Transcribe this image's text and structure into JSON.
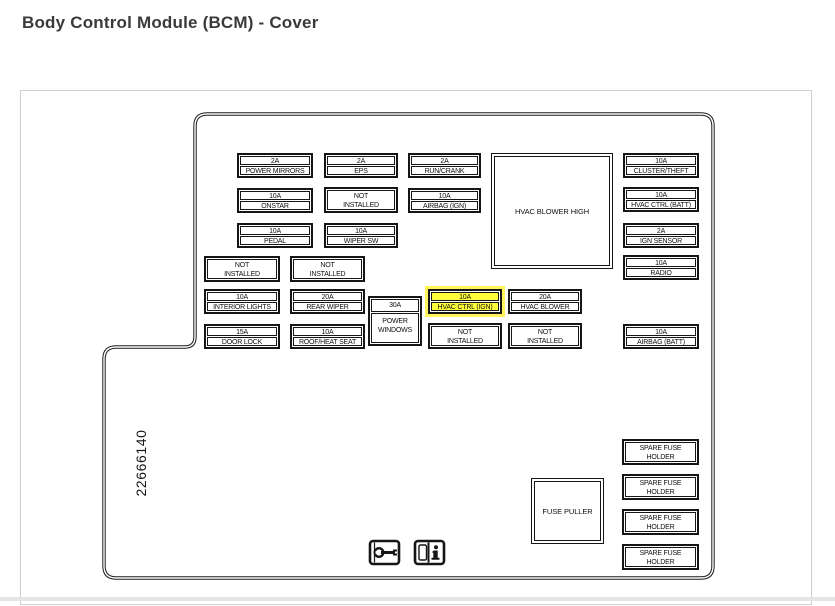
{
  "page": {
    "title": "Body Control Module (BCM) - Cover"
  },
  "diagram": {
    "part_number": "22666140",
    "highlight_color": "#ffff3c",
    "blocks": {
      "hvac_blower_high": "HVAC BLOWER HIGH",
      "fuse_puller": "FUSE PULLER"
    },
    "fuses": [
      {
        "amp": "2A",
        "name": "POWER MIRRORS"
      },
      {
        "amp": "2A",
        "name": "EPS"
      },
      {
        "amp": "2A",
        "name": "RUN/CRANK"
      },
      {
        "amp": "10A",
        "name": "CLUSTER/THEFT"
      },
      {
        "amp": "10A",
        "name": "ONSTAR"
      },
      {
        "label": "NOT\nINSTALLED"
      },
      {
        "amp": "10A",
        "name": "AIRBAG (IGN)"
      },
      {
        "amp": "10A",
        "name": "HVAC CTRL (BATT)"
      },
      {
        "amp": "10A",
        "name": "PEDAL"
      },
      {
        "amp": "10A",
        "name": "WIPER SW"
      },
      {
        "amp": "2A",
        "name": "IGN SENSOR"
      },
      {
        "label": "NOT\nINSTALLED"
      },
      {
        "label": "NOT\nINSTALLED"
      },
      {
        "amp": "10A",
        "name": "RADIO"
      },
      {
        "amp": "10A",
        "name": "INTERIOR LIGHTS"
      },
      {
        "amp": "20A",
        "name": "REAR WIPER"
      },
      {
        "amp": "30A",
        "name": "POWER\nWINDOWS"
      },
      {
        "amp": "10A",
        "name": "HVAC CTRL (IGN)",
        "highlighted": true
      },
      {
        "amp": "20A",
        "name": "HVAC BLOWER"
      },
      {
        "amp": "15A",
        "name": "DOOR LOCK"
      },
      {
        "amp": "10A",
        "name": "ROOF/HEAT SEAT"
      },
      {
        "label": "NOT\nINSTALLED"
      },
      {
        "label": "NOT\nINSTALLED"
      },
      {
        "amp": "10A",
        "name": "AIRBAG (BATT)"
      }
    ],
    "spares": [
      {
        "label": "SPARE FUSE\nHOLDER"
      },
      {
        "label": "SPARE FUSE\nHOLDER"
      },
      {
        "label": "SPARE FUSE\nHOLDER"
      },
      {
        "label": "SPARE FUSE\nHOLDER"
      }
    ],
    "icons": [
      {
        "name": "service-manual-wrench-icon"
      },
      {
        "name": "owners-manual-info-icon"
      }
    ]
  }
}
